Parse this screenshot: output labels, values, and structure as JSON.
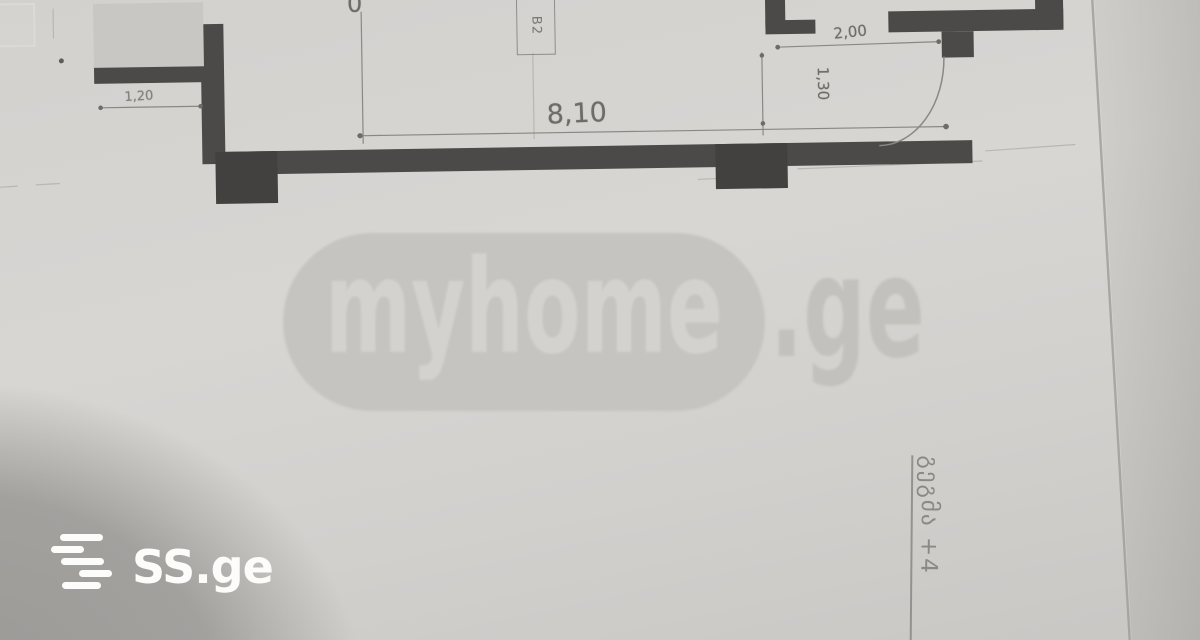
{
  "photo": {
    "watermark": {
      "brand": "myhome",
      "suffix": ".ge"
    },
    "source_logo": {
      "text": "SS.ge"
    },
    "plan": {
      "dim_top_width": "8,10",
      "dim_balcony": "1,20",
      "dim_door_offset": "2,00",
      "dim_door_width": "1,30",
      "clipped_top_text": "0",
      "window_tag": "B2",
      "level_label": "გეგმა +4"
    },
    "colors": {
      "paper": "#d6d4d1",
      "corner_shadow": "#a2a09d",
      "wall": "#4c4a48",
      "dim_line": "#8a8885",
      "dim_text": "#6e6c69",
      "watermark_pill": "#c6c4c1",
      "watermark_text": "#d4d2cf",
      "watermark_suffix": "#c3c1be",
      "logo_white": "#fcfcfb"
    }
  }
}
